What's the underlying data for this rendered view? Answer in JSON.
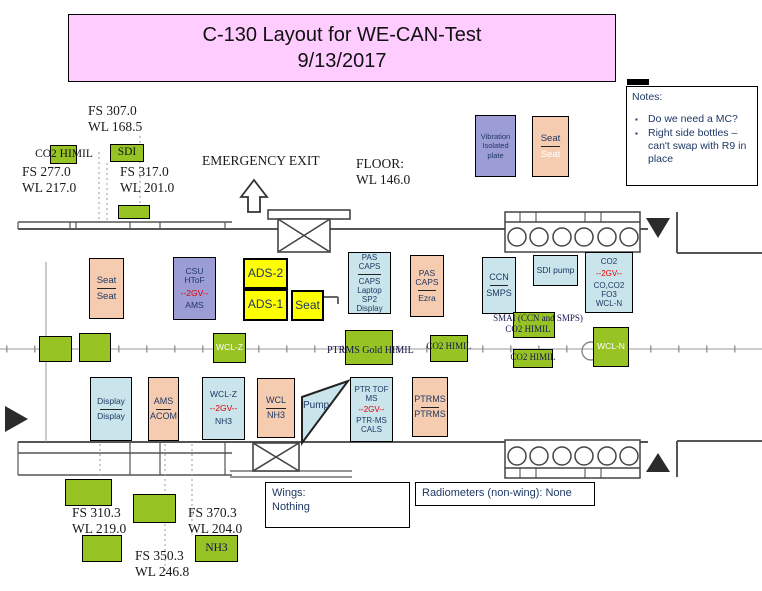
{
  "title": {
    "line1": "C-130 Layout for WE-CAN-Test",
    "line2": "9/13/2017"
  },
  "notes": {
    "heading": "Notes:",
    "bullet1": "Do we need a MC?",
    "bullet2": "Right side bottles – can't swap with R9 in place"
  },
  "stations": {
    "fs307": "FS 307.0\nWL 168.5",
    "fs277": "FS 277.0\nWL 217.0",
    "fs317": "FS 317.0\nWL 201.0",
    "fs310": "FS 310.3\nWL 219.0",
    "fs350": "FS 350.3\nWL 246.8",
    "fs370": "FS 370.3\nWL 204.0"
  },
  "annotations": {
    "emergency_exit": "EMERGENCY EXIT",
    "floor": "FLOOR:\nWL 146.0",
    "wings": "Wings:\nNothing",
    "radiometers": "Radiometers (non-wing): None"
  },
  "green_labels": {
    "co2_himil_top": "CO2 HIMIL",
    "sdi": "SDI",
    "wclz": "WCL-Z",
    "ptrms_gold": "PTRMS Gold HIMIL",
    "co2_himil_mid": "CO2 HIMIL",
    "smai_line1": "SMAI (CCN and SMPS)",
    "smai_line2": "CO2 HIMIL",
    "co2_himil_low": "CO2 HIMIL",
    "wcln": "WCL-N",
    "nh3": "NH3"
  },
  "equipment": {
    "vibration_plate": "Vibration\nIsolated\nplate",
    "seat_top": {
      "top": "Seat",
      "bottom": "Seat"
    },
    "seat_left": {
      "top": "Seat",
      "bottom": "Seat"
    },
    "csu": {
      "top": "CSU\nHToF",
      "gv": "--2GV--",
      "bottom": "AMS"
    },
    "ads2": "ADS-2",
    "ads1": "ADS-1",
    "seat_yellow": "Seat",
    "pas_caps_display": {
      "top": "PAS\nCAPS",
      "bottom": "CAPS\nLaptop\nSP2\nDisplay"
    },
    "pas_caps_ezra": {
      "top": "PAS\nCAPS",
      "bottom": "Ezra"
    },
    "ccn_smps": {
      "top": "CCN",
      "bottom": "SMPS"
    },
    "sdi_pump": "SDI pump",
    "co2_rack": {
      "top": "CO2",
      "gv": "--2GV--",
      "bottom": "CO,CO2\nFO3\nWCL-N"
    },
    "display": {
      "top": "Display",
      "bottom": "Display"
    },
    "ams_acom": {
      "top": "AMS",
      "bottom": "ACOM"
    },
    "wclz_nh3": {
      "top": "WCL-Z",
      "gv": "--2GV--",
      "bottom": "NH3"
    },
    "wcl_nh3": {
      "top": "WCL",
      "bottom": "NH3"
    },
    "pump": "Pump",
    "ptr_tof": {
      "top": "PTR TOF\nMS",
      "gv": "--2GV--",
      "bottom": "PTR-MS\nCALS"
    },
    "ptrms": {
      "top": "PTRMS",
      "bottom": "PTRMS"
    }
  },
  "colors": {
    "green": "#97C325",
    "salmon": "#F6CCB0",
    "light_blue": "#C9E4EB",
    "purple": "#9D9DD6",
    "yellow": "#FFFF00",
    "pink": "#FFCCFF",
    "red_accent": "#E00000",
    "navy_text": "#1F3864"
  }
}
